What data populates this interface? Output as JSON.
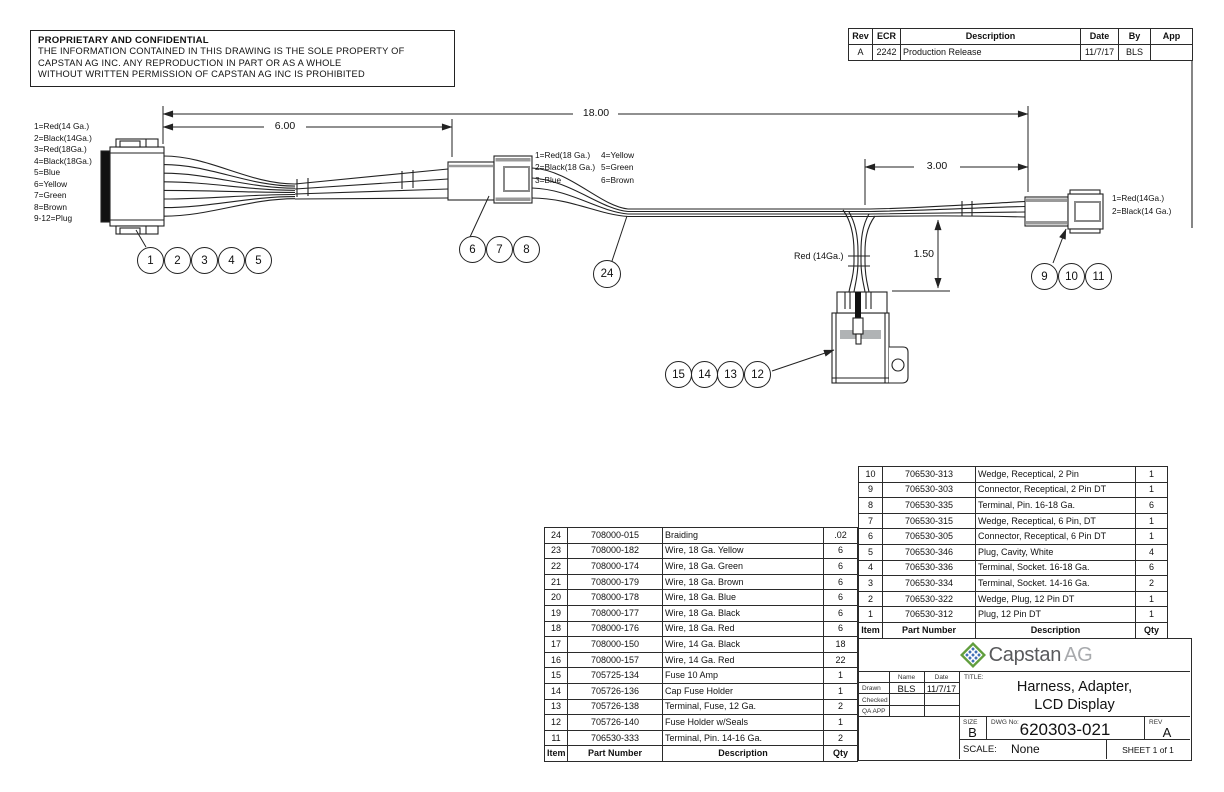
{
  "notice": {
    "title": "PROPRIETARY AND CONFIDENTIAL",
    "lines": [
      "THE INFORMATION CONTAINED IN THIS DRAWING IS THE SOLE PROPERTY OF",
      "CAPSTAN AG INC. ANY REPRODUCTION IN PART OR AS A WHOLE",
      "WITHOUT WRITTEN PERMISSION OF CAPSTAN AG INC IS PROHIBITED"
    ]
  },
  "revision_table": {
    "headers": [
      "Rev",
      "ECR",
      "Description",
      "Date",
      "By",
      "App"
    ],
    "rows": [
      [
        "A",
        "2242",
        "Production Release",
        "11/7/17",
        "BLS",
        ""
      ]
    ]
  },
  "diagram": {
    "legend_left": [
      "1=Red(14 Ga.)",
      "2=Black(14Ga.)",
      "3=Red(18Ga.)",
      "4=Black(18Ga.)",
      "5=Blue",
      "6=Yellow",
      "7=Green",
      "8=Brown",
      "9-12=Plug"
    ],
    "legend_mid_col1": [
      "1=Red(18 Ga.)",
      "2=Black(18 Ga.)",
      "3=Blue"
    ],
    "legend_mid_col2": [
      "4=Yellow",
      "5=Green",
      "6=Brown"
    ],
    "legend_right": [
      "1=Red(14Ga.)",
      "2=Black(14 Ga.)"
    ],
    "branch_wire_label": "Red (14Ga.)",
    "dims": {
      "overall": "18.00",
      "left": "6.00",
      "right": "3.00",
      "drop": "1.50"
    },
    "balloons": {
      "g1": [
        "1",
        "2",
        "3",
        "4",
        "5"
      ],
      "g2": [
        "6",
        "7",
        "8"
      ],
      "g3": [
        "9",
        "10",
        "11"
      ],
      "g4": [
        "15",
        "14",
        "13",
        "12"
      ],
      "braid": "24"
    }
  },
  "bom_left": {
    "headers": [
      "Item",
      "Part Number",
      "Description",
      "Qty"
    ],
    "rows": [
      [
        "24",
        "708000-015",
        "Braiding",
        ".02"
      ],
      [
        "23",
        "708000-182",
        "Wire, 18 Ga. Yellow",
        "6"
      ],
      [
        "22",
        "708000-174",
        "Wire, 18 Ga. Green",
        "6"
      ],
      [
        "21",
        "708000-179",
        "Wire, 18 Ga. Brown",
        "6"
      ],
      [
        "20",
        "708000-178",
        "Wire, 18 Ga. Blue",
        "6"
      ],
      [
        "19",
        "708000-177",
        "Wire, 18 Ga. Black",
        "6"
      ],
      [
        "18",
        "708000-176",
        "Wire, 18 Ga. Red",
        "6"
      ],
      [
        "17",
        "708000-150",
        "Wire, 14 Ga. Black",
        "18"
      ],
      [
        "16",
        "708000-157",
        "Wire, 14 Ga. Red",
        "22"
      ],
      [
        "15",
        "705725-134",
        "Fuse 10 Amp",
        "1"
      ],
      [
        "14",
        "705726-136",
        "Cap Fuse Holder",
        "1"
      ],
      [
        "13",
        "705726-138",
        "Terminal, Fuse, 12 Ga.",
        "2"
      ],
      [
        "12",
        "705726-140",
        "Fuse Holder w/Seals",
        "1"
      ],
      [
        "11",
        "706530-333",
        "Terminal, Pin. 14-16 Ga.",
        "2"
      ]
    ]
  },
  "bom_right": {
    "headers": [
      "Item",
      "Part Number",
      "Description",
      "Qty"
    ],
    "rows": [
      [
        "10",
        "706530-313",
        "Wedge, Receptical, 2 Pin",
        "1"
      ],
      [
        "9",
        "706530-303",
        "Connector, Receptical, 2 Pin DT",
        "1"
      ],
      [
        "8",
        "706530-335",
        "Terminal, Pin. 16-18 Ga.",
        "6"
      ],
      [
        "7",
        "706530-315",
        "Wedge, Receptical, 6 Pin, DT",
        "1"
      ],
      [
        "6",
        "706530-305",
        "Connector, Receptical, 6 Pin DT",
        "1"
      ],
      [
        "5",
        "706530-346",
        "Plug, Cavity, White",
        "4"
      ],
      [
        "4",
        "706530-336",
        "Terminal, Socket. 16-18 Ga.",
        "6"
      ],
      [
        "3",
        "706530-334",
        "Terminal, Socket. 14-16 Ga.",
        "2"
      ],
      [
        "2",
        "706530-322",
        "Wedge, Plug, 12 Pin DT",
        "1"
      ],
      [
        "1",
        "706530-312",
        "Plug, 12 Pin DT",
        "1"
      ]
    ]
  },
  "title_block": {
    "logo_capstan": "Capstan",
    "logo_ag": "AG",
    "approvals": {
      "name_header": "Name",
      "date_header": "Date",
      "rows": [
        {
          "label": "Drawn",
          "name": "BLS",
          "date": "11/7/17"
        },
        {
          "label": "Checked",
          "name": "",
          "date": ""
        },
        {
          "label": "QA APP",
          "name": "",
          "date": ""
        }
      ]
    },
    "title_label": "TITLE:",
    "title_line1": "Harness, Adapter,",
    "title_line2": "LCD Display",
    "size_label": "SIZE",
    "size": "B",
    "dwg_label": "DWG No:",
    "dwg_no": "620303-021",
    "rev_label": "REV",
    "rev": "A",
    "scale_label": "SCALE:",
    "scale": "None",
    "sheet": "SHEET 1 of 1"
  },
  "colors": {
    "line": "#222222",
    "accent_gray": "#999999",
    "logo_green": "#619e3e",
    "logo_blue": "#3f6eb5",
    "logo_text_dark": "#595a5c",
    "logo_text_light": "#a8aaad"
  }
}
